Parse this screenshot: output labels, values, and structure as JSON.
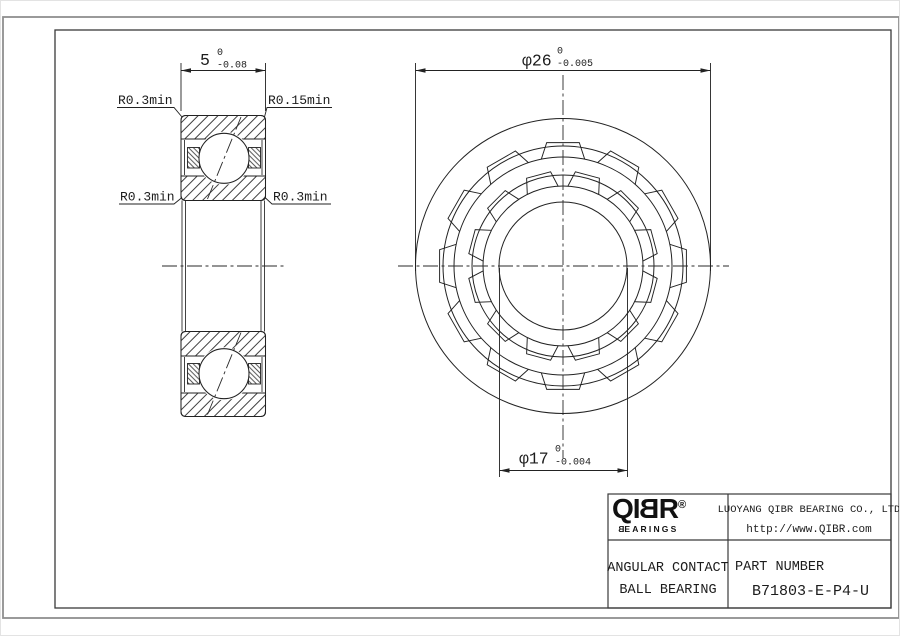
{
  "section_view": {
    "width_dim": {
      "value": "5",
      "tol_upper": "0",
      "tol_lower": "-0.08"
    },
    "labels": {
      "top_left": "R0.3min",
      "top_right": "R0.15min",
      "mid_left": "R0.3min",
      "mid_right": "R0.3min"
    }
  },
  "front_view": {
    "outer_dim": {
      "value": "φ26",
      "tol_upper": "0",
      "tol_lower": "-0.005"
    },
    "bore_dim": {
      "value": "φ17",
      "tol_upper": "0",
      "tol_lower": "-0.004"
    }
  },
  "title_block": {
    "logo": {
      "part1": "QI",
      "part2": "B",
      "part3": "R",
      "reg": "®",
      "sub_part1": "B",
      "sub_part2": "EARINGS"
    },
    "company": "LUOYANG QIBR BEARING CO., LTD",
    "website": "http://www.QIBR.com",
    "product_type_line1": "ANGULAR CONTACT",
    "product_type_line2": "BALL BEARING",
    "part_number_label": "PART NUMBER",
    "part_number": "B71803-E-P4-U"
  },
  "colors": {
    "line": "#222222",
    "border_outer": "#8f8f8f",
    "border_inner": "#3a3a3a"
  }
}
